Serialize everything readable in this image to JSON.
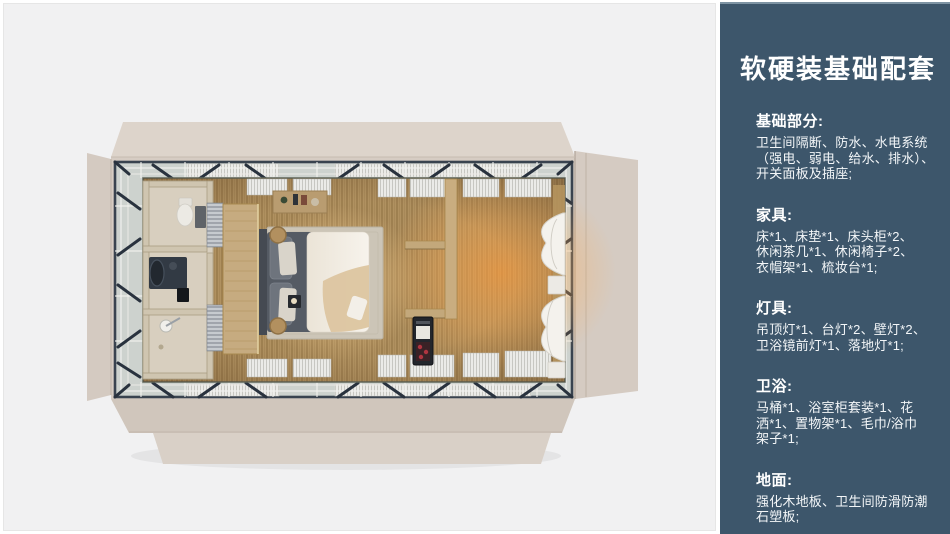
{
  "palette": {
    "page_bg": "#ffffff",
    "canvas_bg": "#f1f1f2",
    "panel_bg": "#3d566b",
    "panel_text": "#ffffff",
    "deck_beige": "#d6ccc3",
    "frame_dark": "#333d4a",
    "wood_floor": "#b09160",
    "glow_orange": "#ff9e3e",
    "bathroom_wall": "#cfc5b0",
    "duvet_white": "#f4efe8"
  },
  "panel": {
    "title": "软硬装基础配套",
    "sections": [
      {
        "heading": "基础部分:",
        "body": "卫生间隔断、防水、水电系统\n（强电、弱电、给水、排水）、\n开关面板及插座;"
      },
      {
        "heading": "家具:",
        "body": "床*1、床垫*1、床头柜*2、\n休闲茶几*1、休闲椅子*2、\n衣帽架*1、梳妆台*1;"
      },
      {
        "heading": "灯具:",
        "body": "吊顶灯*1、台灯*2、壁灯*2、\n卫浴镜前灯*1、落地灯*1;"
      },
      {
        "heading": "卫浴:",
        "body": "马桶*1、浴室柜套装*1、花\n洒*1、置物架*1、毛巾/浴巾\n架子*1;"
      },
      {
        "heading": "地面:",
        "body": "强化木地板、卫生间防滑防潮\n石塑板;"
      }
    ]
  }
}
